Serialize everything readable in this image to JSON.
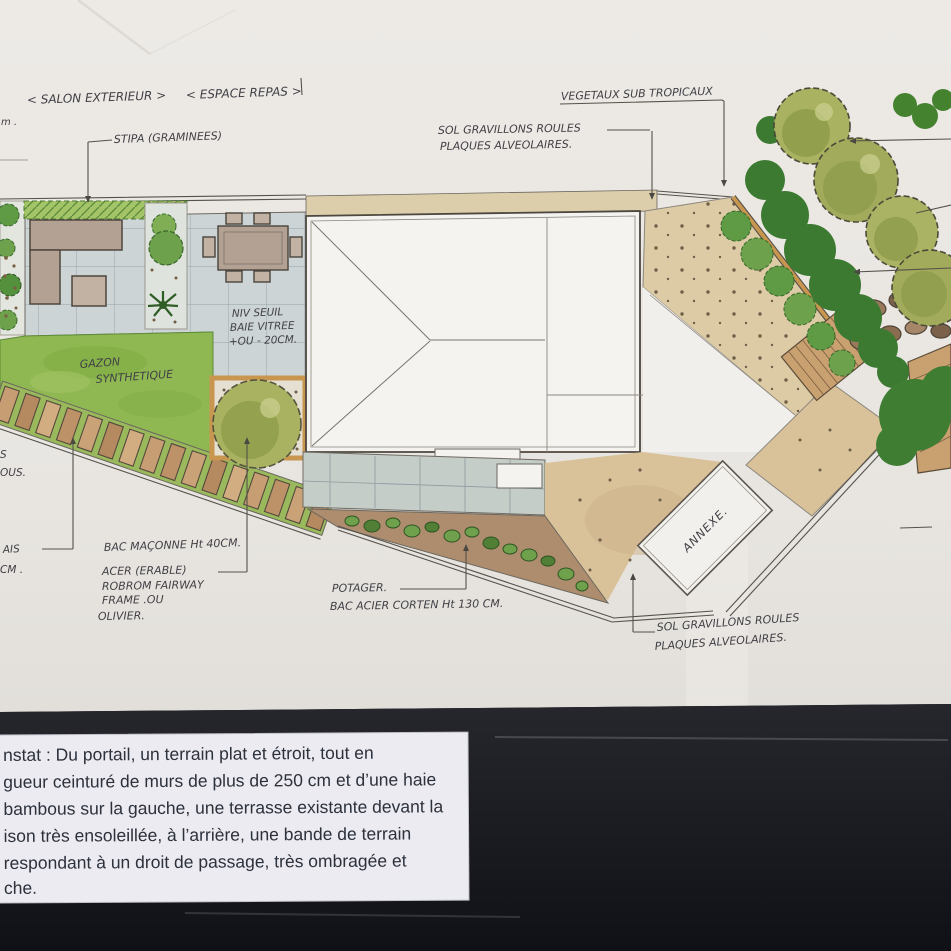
{
  "plan": {
    "labels": {
      "salon": "< SALON EXTERIEUR >",
      "espace": "< ESPACE REPAS >",
      "stipa": "STIPA (GRAMINEES)",
      "vegetaux": "VEGETAUX SUB TROPICAUX",
      "sol_top_1": "SOL GRAVILLONS ROULES",
      "sol_top_2": "PLAQUES ALVEOLAIRES.",
      "niv_1": "NIV SEUIL",
      "niv_2": "BAIE VITREE",
      "niv_3": "+OU - 20CM.",
      "gazon_1": "GAZON",
      "gazon_2": "SYNTHETIQUE",
      "bac_maconne": "BAC MAÇONNE Ht 40CM.",
      "acer_1": "ACER (ERABLE)",
      "acer_2": "ROBROM FAIRWAY",
      "acer_3": "FRAME .OU",
      "acer_4": "OLIVIER.",
      "potager_1": "POTAGER.",
      "potager_2": "BAC ACIER CORTEN Ht 130 CM.",
      "annexe": "ANNEXE.",
      "sol_bottom_1": "SOL GRAVILLONS ROULES",
      "sol_bottom_2": "PLAQUES ALVEOLAIRES.",
      "frag_top_left": "m .",
      "frag_s": "S",
      "frag_ous": "OUS.",
      "frag_ais": "AIS",
      "frag_cm": "CM ."
    },
    "colors": {
      "paper": "#e9e6e2",
      "ink": "#403f45",
      "lawn": "#8fb853",
      "hedge": "#a4c468",
      "pavers": "#ccd4d6",
      "rear_pavers": "#c4cdc7",
      "gravel": "#ddcba6",
      "soil": "#ad8d6d",
      "wood": "#c9a06f",
      "fence": "#c8964e",
      "tree": "#a9b261",
      "shrub_dark": "#3c7a31",
      "dark_bg": "#15161b",
      "caption_bg": "#ecebf1",
      "caption_text": "#2c313c"
    }
  },
  "caption": {
    "lines": [
      "nstat : Du portail, un terrain plat et étroit, tout en",
      "gueur ceinturé de murs de plus de 250 cm et d’une haie",
      "bambous sur la gauche, une terrasse existante devant la",
      "ison très ensoleillée, à l’arrière, une bande de terrain",
      "respondant à un droit de passage,  très ombragée et",
      "che."
    ]
  }
}
